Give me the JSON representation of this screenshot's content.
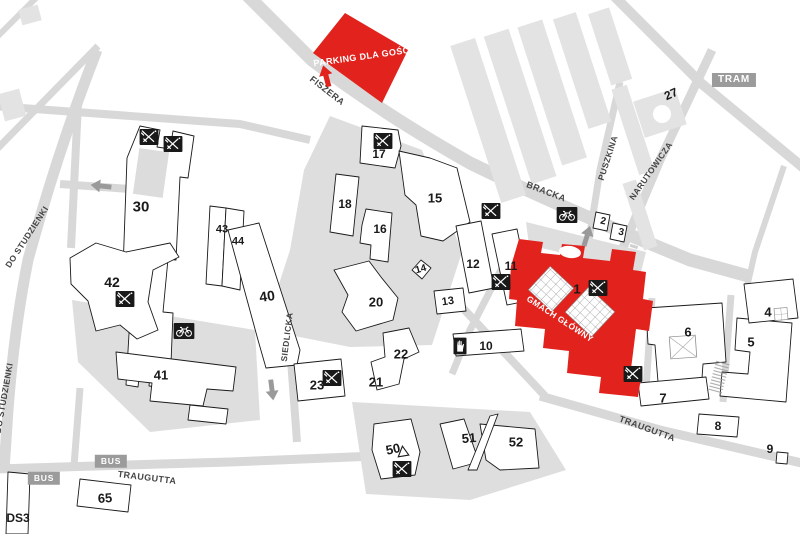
{
  "areas": {
    "parking_label": "PARKING DLA GOŚCI",
    "main_building_label": "GMACH GŁÓWNY"
  },
  "transit": {
    "tram": "TRAM",
    "bus_1": "BUS",
    "bus_2": "BUS",
    "dorm": "DS3"
  },
  "streets": {
    "fiszera": "FISZERA",
    "bracka": "BRACKA",
    "puszkina": "PUSZKINA",
    "narutowicza": "NARUTOWICZA",
    "do_studzienki_1": "DO STUDZIENKI",
    "do_studzienki_2": "DO STUDZIENKI",
    "siedlicka": "SIEDLICKA",
    "traugutta_1": "TRAUGUTTA",
    "traugutta_2": "TRAUGUTTA"
  },
  "buildings": {
    "b1": "1",
    "b2": "2",
    "b3": "3",
    "b4": "4",
    "b5": "5",
    "b6": "6",
    "b7": "7",
    "b8": "8",
    "b9": "9",
    "b10": "10",
    "b11": "11",
    "b12": "12",
    "b13": "13",
    "b14": "14",
    "b15": "15",
    "b16": "16",
    "b17": "17",
    "b18": "18",
    "b20": "20",
    "b21": "21",
    "b22": "22",
    "b23": "23",
    "b27": "27",
    "b30": "30",
    "b40": "40",
    "b41": "41",
    "b42": "42",
    "b43": "43",
    "b44": "44",
    "b50": "50",
    "b51": "51",
    "b52": "52",
    "b65": "65"
  },
  "icons": {
    "food": "crossed-cutlery-in-black-square",
    "bike_parking": "bicycle-in-black-square",
    "hand": "hand-in-black-square",
    "sailing": "outlined-sail-triangle",
    "direction_arrow": "solid-direction-arrow"
  },
  "colors": {
    "accent_red": "#e2231d",
    "road_gray": "#d8d8d8",
    "block_gray": "#e3e3e3",
    "plaza_gray": "#dedede",
    "tag_gray": "#9b9b9b",
    "outline_black": "#1a1a1a"
  }
}
